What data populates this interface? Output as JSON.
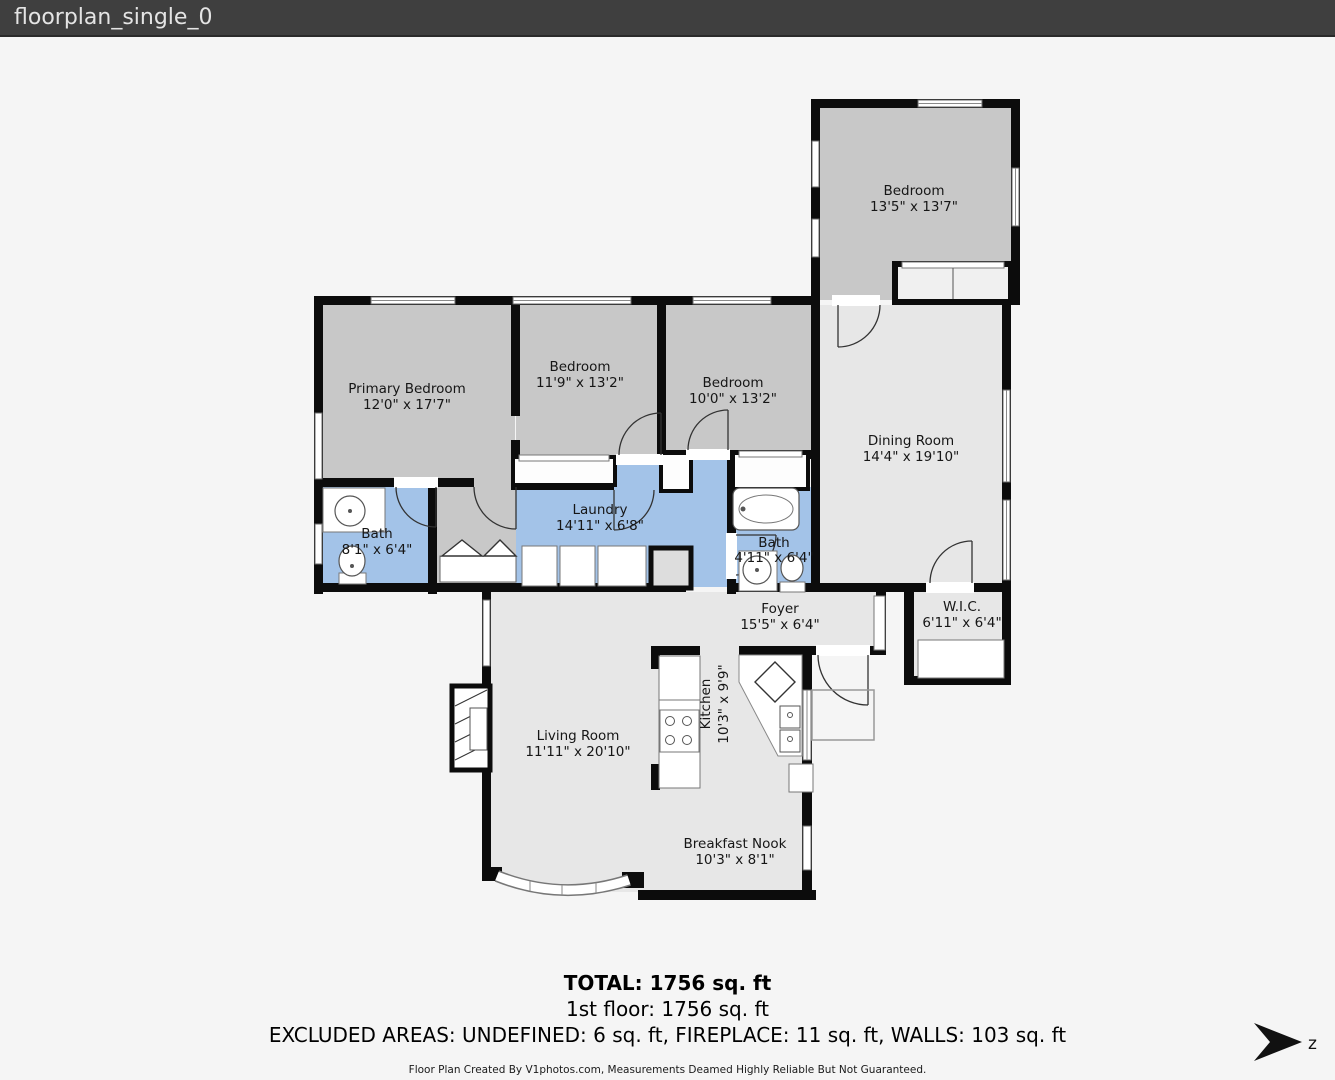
{
  "header": {
    "title": "floorplan_single_0"
  },
  "rooms": {
    "bedroom_tr": {
      "name": "Bedroom",
      "dims": "13'5\" x 13'7\""
    },
    "primary": {
      "name": "Primary Bedroom",
      "dims": "12'0\" x 17'7\""
    },
    "bedroom2": {
      "name": "Bedroom",
      "dims": "11'9\" x 13'2\""
    },
    "bedroom3": {
      "name": "Bedroom",
      "dims": "10'0\" x 13'2\""
    },
    "dining": {
      "name": "Dining Room",
      "dims": "14'4\" x 19'10\""
    },
    "bath1": {
      "name": "Bath",
      "dims": "8'1\" x 6'4\""
    },
    "laundry": {
      "name": "Laundry",
      "dims": "14'11\" x 6'8\""
    },
    "bath2": {
      "name": "Bath",
      "dims": "4'11\" x 6'4\""
    },
    "foyer": {
      "name": "Foyer",
      "dims": "15'5\" x 6'4\""
    },
    "wic": {
      "name": "W.I.C.",
      "dims": "6'11\" x 6'4\""
    },
    "living": {
      "name": "Living Room",
      "dims": "11'11\" x 20'10\""
    },
    "kitchen": {
      "name": "Kitchen",
      "dims": "10'3\" x 9'9\""
    },
    "nook": {
      "name": "Breakfast Nook",
      "dims": "10'3\" x 8'1\""
    }
  },
  "footer": {
    "total": "TOTAL: 1756 sq. ft",
    "floor1": "1st floor: 1756 sq. ft",
    "excluded": "EXCLUDED AREAS: UNDEFINED: 6 sq. ft, FIREPLACE: 11 sq. ft, WALLS: 103 sq. ft",
    "credit": "Floor Plan Created By V1photos.com, Measurements Deamed Highly Reliable But Not Guaranteed."
  },
  "compass": {
    "label": "z"
  },
  "colors": {
    "wall": "#0c0c0c",
    "bedroom_fill": "#c8c8c8",
    "common_fill": "#e7e7e7",
    "wet_fill": "#a3c3e8",
    "titlebar_bg": "#3f3f3f"
  }
}
